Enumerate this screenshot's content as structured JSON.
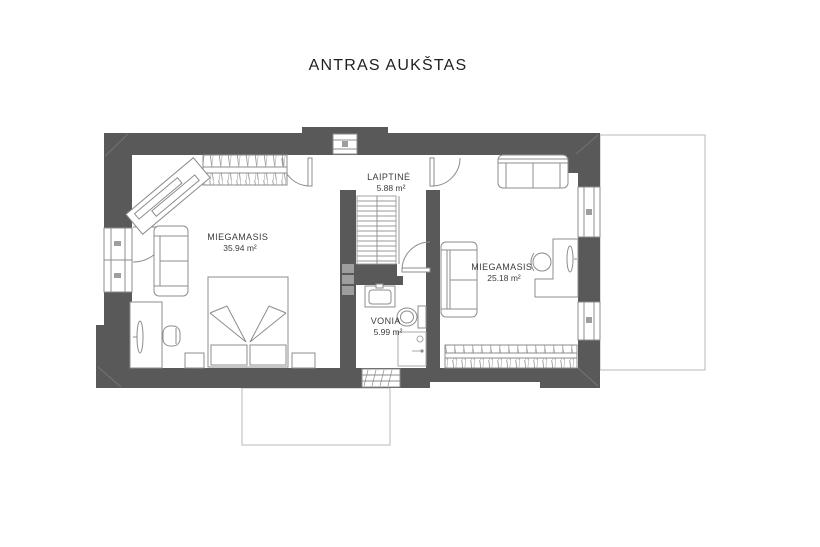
{
  "title": "ANTRAS AUKŠTAS",
  "floor_plan": {
    "rooms": [
      {
        "name": "MIEGAMASIS",
        "area": "35.94 m²"
      },
      {
        "name": "LAIPTINĖ",
        "area": "5.88 m²"
      },
      {
        "name": "VONIA",
        "area": "5.99 m²"
      },
      {
        "name": "MIEGAMASIS",
        "area": "25.18 m²"
      }
    ],
    "colors": {
      "wall": "#595959",
      "furniture_line": "#8c8c8c",
      "terrace_outline": "#b8b8b8",
      "text": "#3c3c3c"
    }
  }
}
